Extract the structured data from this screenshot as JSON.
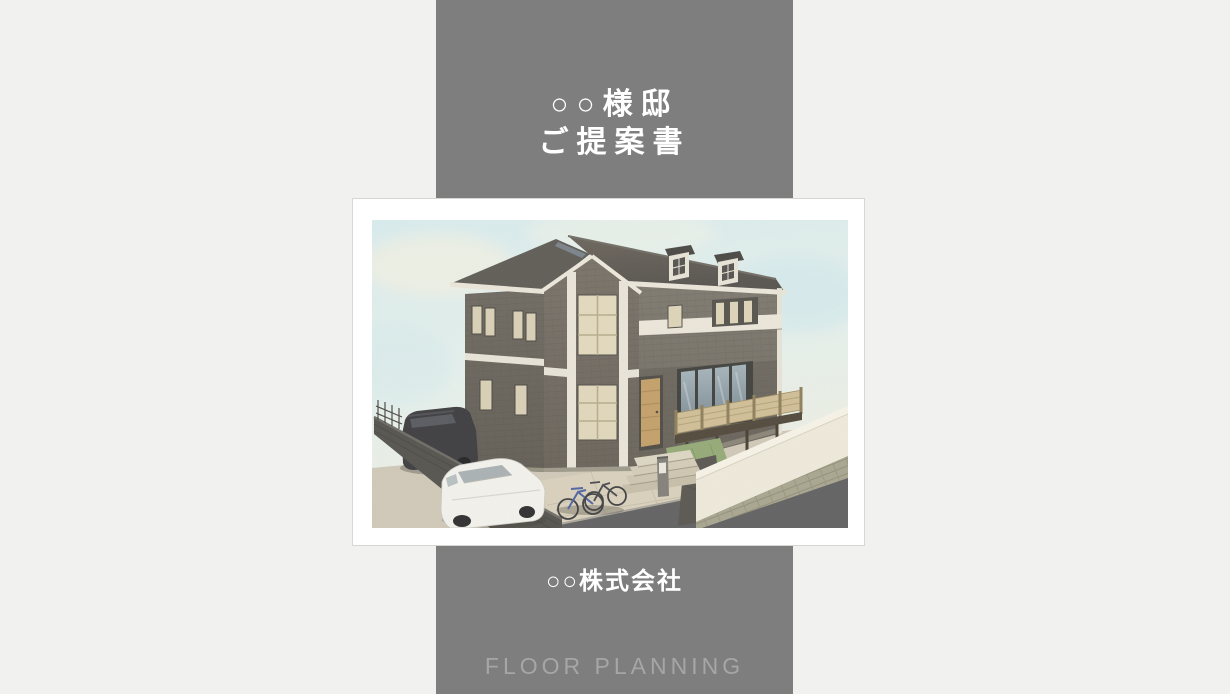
{
  "page": {
    "background_color": "#f1f1f0",
    "band_color": "#7e7e7e",
    "card_background": "#ffffff",
    "card_border_color": "#d7d7d5"
  },
  "title": {
    "line1": "○○様邸",
    "line2": "ご提案書",
    "color": "#ffffff"
  },
  "company": {
    "name": "○○株式会社",
    "color": "#ffffff"
  },
  "footer": {
    "label": "FLOOR PLANNING",
    "color": "#a6a6a6"
  },
  "illustration": {
    "name": "house-exterior-3d-rendering",
    "description": "Watercolor-style 3D rendering of a two-story dark brick house with gabled roof, two dormer windows, white vertical trim strips, wooden deck with slatted fence, white retaining wall, dark minivan and white compact car parked at left, bicycles by the entrance",
    "sky_color": "#ddeef0",
    "roof_color": "#5d5a55",
    "wall_color": "#6e6962",
    "trim_color": "#e9e4d8",
    "road_color": "#5e5d5f"
  }
}
